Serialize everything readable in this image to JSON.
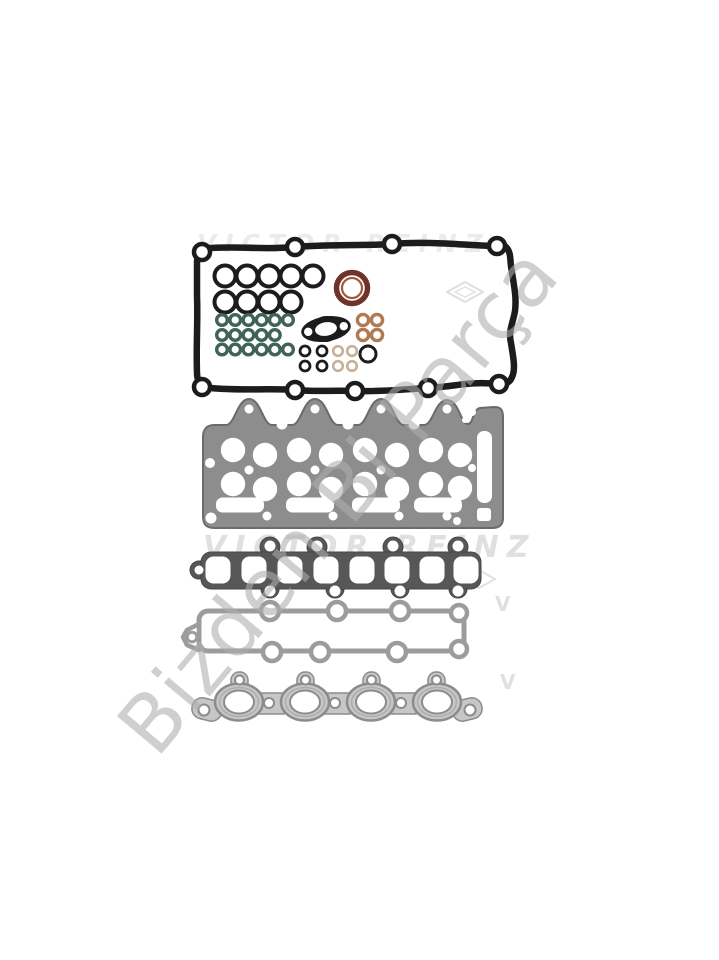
{
  "watermarks": {
    "brand_top": "VICTOR REINZ",
    "brand_middle": "VICTOR REINZ",
    "brand_initial": "V",
    "diagonal": "Bizden Bi Parça"
  },
  "colors": {
    "background": "#ffffff",
    "rubber_black": "#1c1c1c",
    "seal_brown": "#6f3429",
    "seal_brown_inner": "#9c5a40",
    "oring_green": "#406356",
    "washer_copper": "#b07a52",
    "washer_tan": "#c9b199",
    "head_gray": "#8d8d8d",
    "head_edge": "#6b6b6b",
    "intake_gray": "#575757",
    "plenum_gray": "#9c9c9c",
    "exhaust_gray": "#c7c7c7",
    "exhaust_edge": "#8c8c8c",
    "brand_wm": "#e0e0e0",
    "brand_wm_light": "#ebebeb",
    "diagonal_wm": "#aeaeae"
  }
}
